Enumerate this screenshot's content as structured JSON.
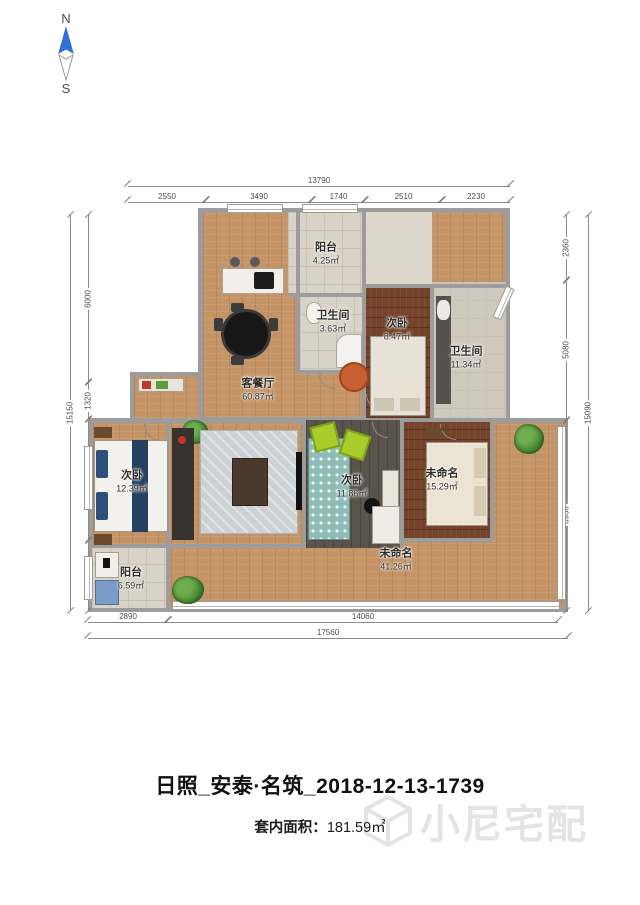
{
  "compass": {
    "north": "N",
    "south": "S"
  },
  "title": "日照_安泰·名筑_2018-12-13-1739",
  "footer": {
    "area_label": "套内面积：",
    "area_value": "181.59㎡"
  },
  "watermark_text": "小尼宅配",
  "colors": {
    "compass_north": "#2e6fd8",
    "wood_floor": "#c49467",
    "dark_wood_floor": "#74432a",
    "gray_floor": "#5a544c",
    "tile_floor": "#d9d3c7",
    "wall": "#9c9c9c"
  },
  "rooms": [
    {
      "name": "阳台",
      "area": "4.25㎡"
    },
    {
      "name": "卫生间",
      "area": "3.63㎡"
    },
    {
      "name": "次卧",
      "area": "8.47㎡"
    },
    {
      "name": "卫生间",
      "area": "11.34㎡"
    },
    {
      "name": "客餐厅",
      "area": "60.87㎡"
    },
    {
      "name": "次卧",
      "area": "12.39㎡"
    },
    {
      "name": "次卧",
      "area": "11.86㎡"
    },
    {
      "name": "未命名",
      "area": "15.29㎡"
    },
    {
      "name": "未命名",
      "area": "41.26㎡"
    },
    {
      "name": "阳台",
      "area": "6.59㎡"
    }
  ],
  "dimensions": {
    "top": {
      "overall": "13790",
      "segments": [
        "2550",
        "3490",
        "1740",
        "2510",
        "2230"
      ]
    },
    "left": {
      "overall": "15150",
      "segments": [
        "6000",
        "1320",
        "4350",
        "2280"
      ]
    },
    "right": {
      "overall": "15090",
      "segments": [
        "2360",
        "5080",
        "6930"
      ]
    },
    "bottom": {
      "overall": "17560",
      "segments": [
        "2890",
        "14060"
      ]
    }
  }
}
